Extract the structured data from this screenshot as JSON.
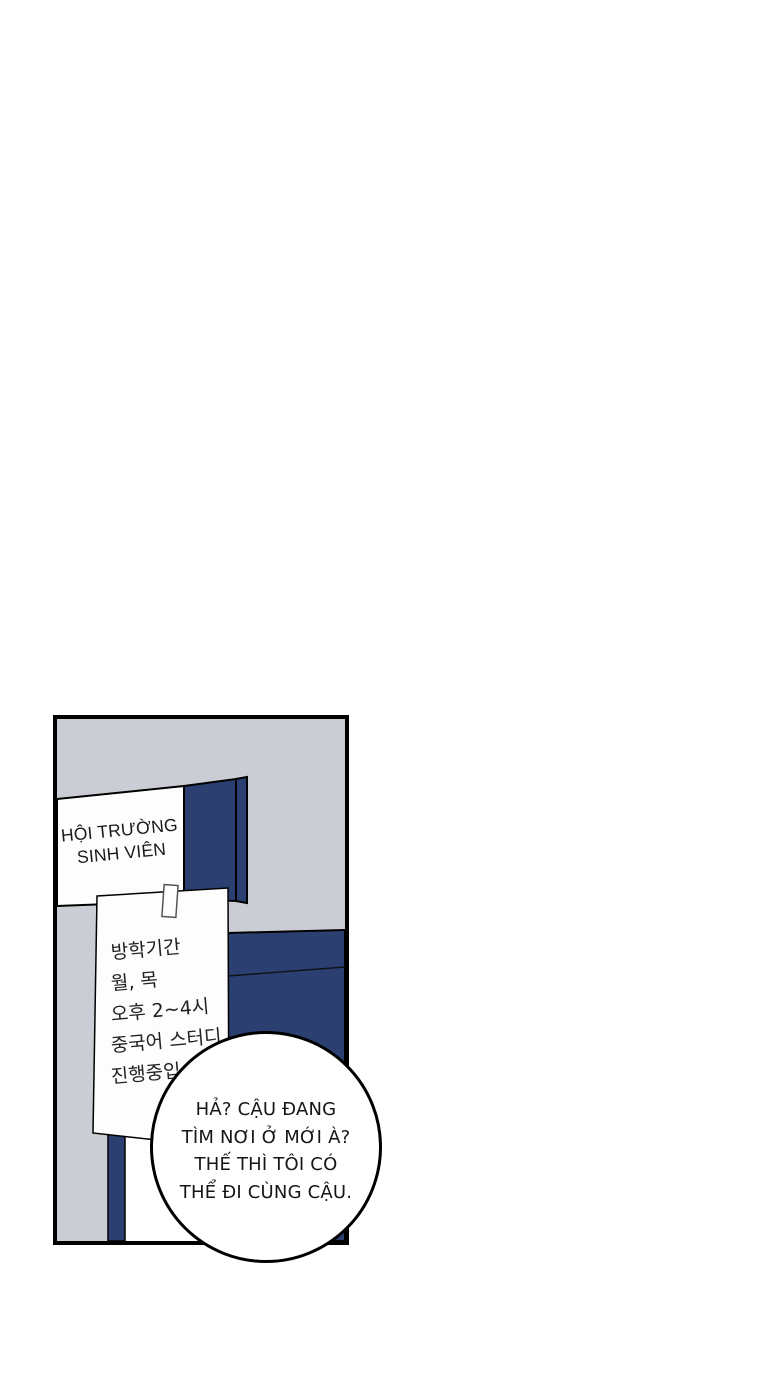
{
  "page": {
    "background_color": "#ffffff"
  },
  "panel": {
    "colors": {
      "wall_gray": "#cbcdd4",
      "board_blue": "#2b4070",
      "outline_black": "#000000",
      "paper_white": "#fdfdfd"
    },
    "sign": {
      "line1": "HỘI TRƯỜNG",
      "line2": "SINH VIÊN"
    },
    "notice_paper": {
      "lines": [
        "방학기간",
        "월, 목",
        "오후 2~4시",
        "중국어 스터디",
        "진행중입"
      ]
    },
    "speech_bubble": {
      "lines": [
        "HẢ? CẬU ĐANG",
        "TÌM NƠI Ở MỚI À?",
        "THẾ THÌ TÔI CÓ",
        "THỂ ĐI CÙNG CẬU."
      ]
    }
  }
}
